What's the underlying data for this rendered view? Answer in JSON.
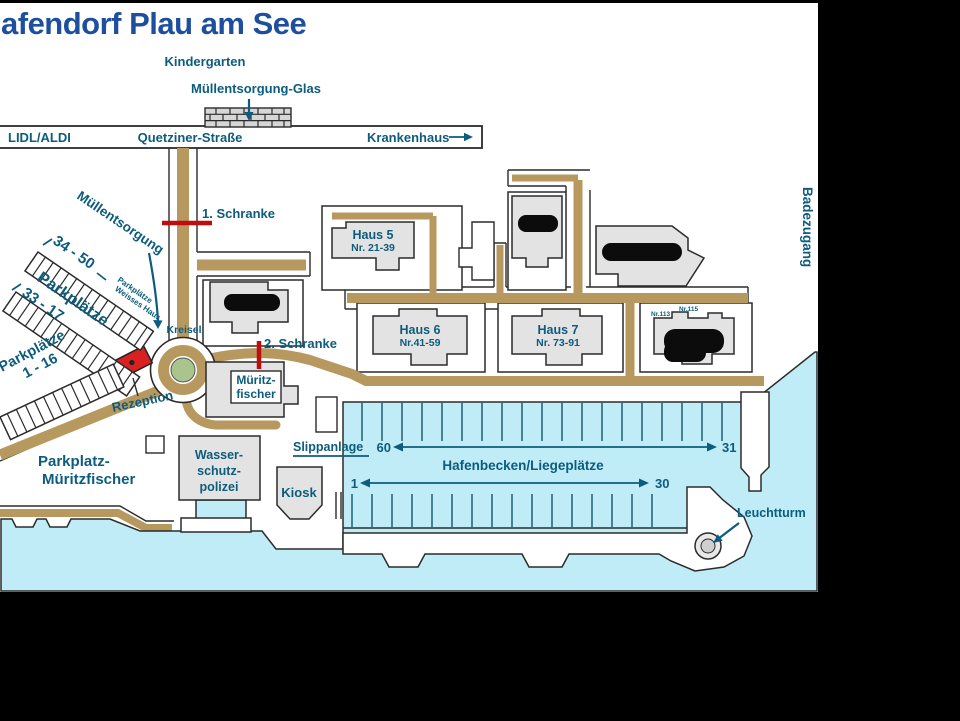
{
  "title": "afendorf Plau am See",
  "street": {
    "left_label": "LIDL/ALDI",
    "name": "Quetziner-Straße",
    "right_label": "Krankenhaus"
  },
  "landmarks": {
    "kindergarten": "Kindergarten",
    "muell_glas": "Müllentsorgung-Glas",
    "muellentsorgung": "Müllentsorgung",
    "schranke1": "1. Schranke",
    "schranke2": "2. Schranke",
    "kreisel": "Kreisel",
    "rezeption": "Rezeption",
    "badezugang": "Badezugang",
    "leuchtturm": "Leuchtturm",
    "slippanlage": "Slippanlage",
    "hafenbecken": "Hafenbecken/Liegeplätze",
    "kiosk": "Kiosk",
    "wasserschutzpolizei": [
      "Wasser-",
      "schutz-",
      "polizei"
    ],
    "mueritzfischer": [
      "Müritz-",
      "fischer"
    ],
    "parkplatz_mueritzfischer": [
      "Parkplatz-",
      "Müritzfischer"
    ]
  },
  "parking": {
    "range_a": "34 - 50",
    "range_b": "33 - 17",
    "parkplaetze": "Parkplätze",
    "weisses_haus": [
      "Parkplätze",
      "Weisses Haus"
    ],
    "one_sixteen": [
      "Parkplätze",
      "1 - 16"
    ]
  },
  "houses": [
    {
      "name": "Haus 5",
      "nr": "Nr. 21-39"
    },
    {
      "name": "Haus 6",
      "nr": "Nr.41-59"
    },
    {
      "name": "Haus 7",
      "nr": "Nr. 73-91"
    }
  ],
  "building_numbers": [
    "Nr.113",
    "Nr.115"
  ],
  "berths": {
    "row1_left": "60",
    "row1_right": "31",
    "row2_left": "1",
    "row2_right": "30"
  },
  "colors": {
    "title": "#1e4f9e",
    "label": "#0d5c7d",
    "road": "#b7995f",
    "water": "#bfecf7",
    "barrier": "#c00c0c",
    "reception": "#d92121",
    "green": "#a9c48c",
    "building": "#e3e3e3"
  }
}
